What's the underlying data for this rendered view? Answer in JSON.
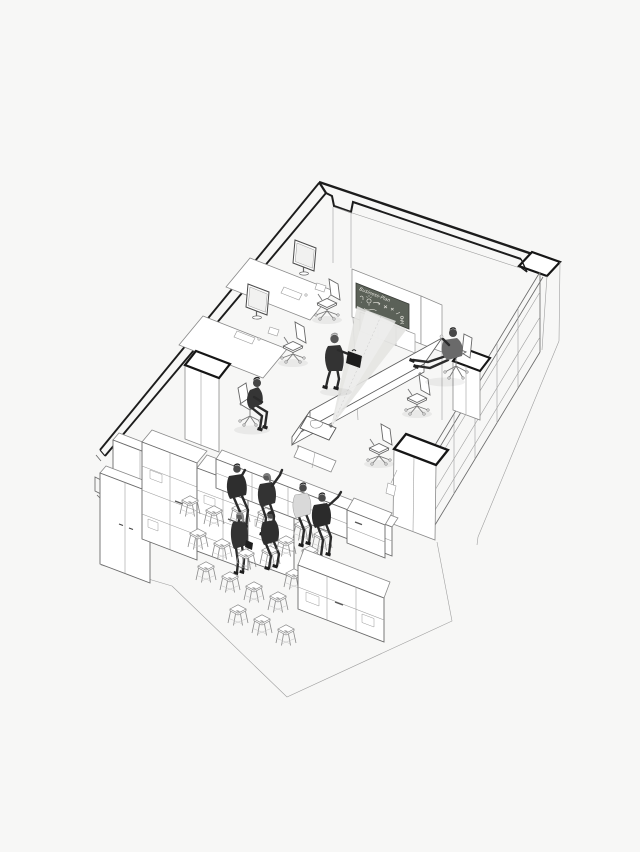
{
  "board": {
    "label": "Business-Plan"
  },
  "palette": {
    "background": "#f7f7f6",
    "ink": "#1c1c1c",
    "line": "#6b6b6b",
    "faint": "#b5b5b5",
    "board": "#5b6158",
    "board_ink": "#eceae4",
    "cone": "#e4e4e2",
    "cone_core": "#efefee",
    "figure_dark": "#2e2e2e",
    "figure_light": "#d9d9d9"
  },
  "inventory": {
    "people": 9,
    "stools": 20,
    "office_chairs": 6,
    "desks": 2,
    "monitors": 2,
    "conference_tables": 1,
    "projectors": 1,
    "presentation_boards": 1,
    "lockers": 2,
    "shelving_units": 6,
    "columns": 3
  }
}
